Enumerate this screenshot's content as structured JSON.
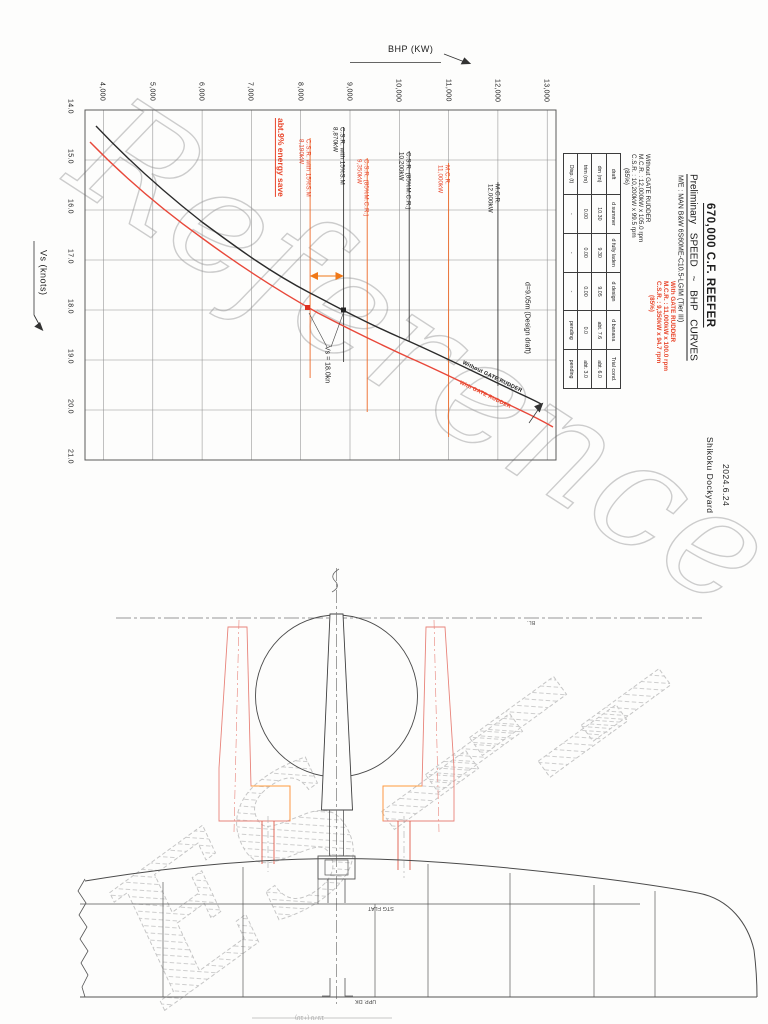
{
  "sheet1": {
    "title": "670,000 C.F. REEFER",
    "subtitle": "Preliminary SPEED ~ BHP CURVES",
    "engine_line": "M/E : MAN B&W 6S60ME-C10.5-LGIM (Tier III)",
    "without_block": {
      "l1": "Without GATE RUDDER",
      "l2": "M.C.R. : 12,000kW x 105.0 rpm",
      "l3": "C.S.R. : 10,200kW x 99.5 rpm",
      "l4": "(85%)"
    },
    "with_block": {
      "l1": "With GATE RUDDER",
      "l2": "M.C.R. : 11,000kW x 100.0 rpm",
      "l3": "C.S.R. : 9,350kW x 94.7 rpm",
      "l4": "(85%)"
    },
    "table": {
      "headers": [
        "draft",
        "d summer",
        "d fully laden",
        "d design",
        "d banana",
        "Trial cond."
      ],
      "rows": [
        [
          "dm (m)",
          "10.30",
          "9.30",
          "9.05",
          "abt. 7.6",
          "abt. 6.0"
        ],
        [
          "trim (m)",
          "0.00",
          "0.00",
          "0.00",
          "0.0",
          "abt. 3.0"
        ],
        [
          "Disp. (t)",
          "-",
          "-",
          "-",
          "pending",
          "pending"
        ]
      ]
    },
    "axis": {
      "x_label": "BHP (KW)",
      "y_label": "Vs (knots)"
    },
    "bhp_ticks": [
      "4,000",
      "5,000",
      "6,000",
      "7,000",
      "8,000",
      "9,000",
      "10,000",
      "11,000",
      "12,000",
      "13,000"
    ],
    "vs_ticks": [
      "14.0",
      "15.0",
      "16.0",
      "17.0",
      "18.0",
      "19.0",
      "20.0",
      "21.0"
    ],
    "markers": [
      {
        "name": "C.S.R. with 15%S.M",
        "value": "8,190kW",
        "color": "red"
      },
      {
        "name": "C.S.R. with 15%S.M",
        "value": "8,870kW",
        "color": "black"
      },
      {
        "name": "C.S.R. (85%M.C.R.)",
        "value": "9,350kW",
        "color": "red"
      },
      {
        "name": "C.S.R. (85%M.C.R.)",
        "value": "10,200kW",
        "color": "black"
      },
      {
        "name": "M.C.R.",
        "value": "11,000kW",
        "color": "red"
      },
      {
        "name": "M.C.R.",
        "value": "12,000kW",
        "color": "black"
      }
    ],
    "annotations": {
      "energy_save": "abt.9% energy save",
      "speed_point": "Vs = 18.0kn",
      "design_draft": "d=9.05m (Design draft)",
      "curve_without": "Without GATE RUDDER",
      "curve_with": "With GATE RUDDER"
    },
    "date": "2024.6.24",
    "yard": "Shikoku Dockyard",
    "watermark": "Reference"
  },
  "sheet2": {
    "baseline_label": "BL.",
    "stg_flat_label": "STG FLAT",
    "upper_deck_label": "UPP. DK",
    "bottom_dimension": "1970 (+10)",
    "watermark": "ES"
  },
  "colors": {
    "accent_red": "#e8452a",
    "accent_orange": "#f07818",
    "gate_rudder_outline": "#e8837a"
  },
  "chart_data": {
    "type": "line",
    "title": "Preliminary SPEED ~ BHP CURVES",
    "xlabel": "Vs (knots)",
    "ylabel": "BHP (KW)",
    "xlim": [
      14.0,
      21.0
    ],
    "ylim": [
      4000,
      13000
    ],
    "x_ticks": [
      14.0,
      15.0,
      16.0,
      17.0,
      18.0,
      19.0,
      20.0,
      21.0
    ],
    "y_ticks": [
      4000,
      5000,
      6000,
      7000,
      8000,
      9000,
      10000,
      11000,
      12000,
      13000
    ],
    "grid": true,
    "note": "page scanned rotated 90deg clockwise: BHP axis runs horizontally, Vs axis vertically",
    "series": [
      {
        "name": "Without GATE RUDDER",
        "color": "#2b2b2b",
        "points": [
          [
            14.6,
            4000
          ],
          [
            15.4,
            5000
          ],
          [
            16.2,
            6000
          ],
          [
            17.0,
            7000
          ],
          [
            17.6,
            8000
          ],
          [
            18.0,
            8870
          ],
          [
            18.55,
            10000
          ],
          [
            19.0,
            11000
          ],
          [
            19.45,
            12000
          ],
          [
            19.9,
            12900
          ]
        ]
      },
      {
        "name": "With GATE RUDDER",
        "color": "#e8483a",
        "points": [
          [
            14.95,
            4000
          ],
          [
            15.8,
            5000
          ],
          [
            16.6,
            6000
          ],
          [
            17.4,
            7000
          ],
          [
            18.0,
            8190
          ],
          [
            18.5,
            9000
          ],
          [
            19.0,
            10100
          ],
          [
            19.5,
            11150
          ],
          [
            19.95,
            12100
          ],
          [
            20.4,
            13000
          ]
        ]
      }
    ],
    "reference_lines_kw": [
      {
        "label": "C.S.R. with 15%S.M 8,190kW",
        "kw": 8190,
        "series": "With GATE RUDDER"
      },
      {
        "label": "C.S.R. with 15%S.M 8,870kW",
        "kw": 8870,
        "series": "Without GATE RUDDER"
      },
      {
        "label": "C.S.R. (85%M.C.R.) 9,350kW",
        "kw": 9350,
        "series": "With GATE RUDDER"
      },
      {
        "label": "C.S.R. (85%M.C.R.) 10,200kW",
        "kw": 10200,
        "series": "Without GATE RUDDER"
      },
      {
        "label": "M.C.R. 11,000kW",
        "kw": 11000,
        "series": "With GATE RUDDER"
      },
      {
        "label": "M.C.R. 12,000kW",
        "kw": 12000,
        "series": "Without GATE RUDDER"
      }
    ],
    "annotations": [
      "abt.9% energy save",
      "Vs = 18.0kn",
      "d=9.05m (Design draft)"
    ]
  }
}
